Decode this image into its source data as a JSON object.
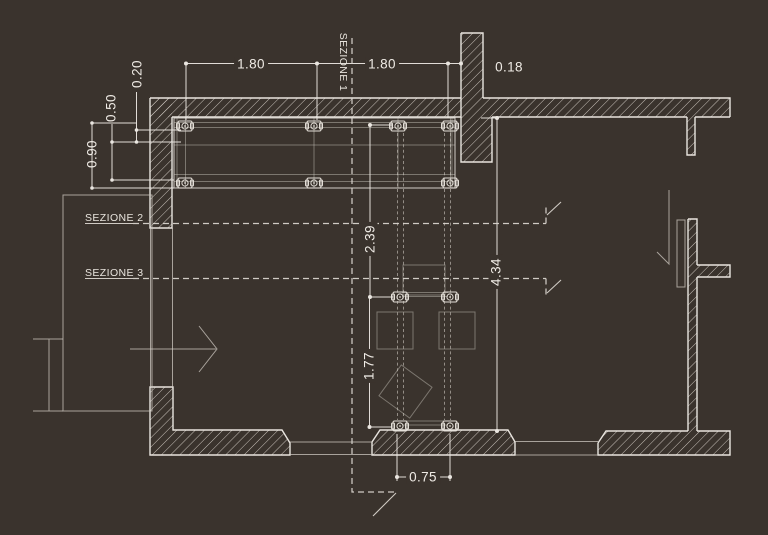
{
  "drawing": {
    "type": "architectural floor plan",
    "colors": {
      "background": "#3a332d",
      "line": "#e9e5df",
      "text": "#efebe5"
    },
    "dimensions": {
      "top_span_left": "1.80",
      "top_span_right": "1.80",
      "wall_thickness": "0.18",
      "offset_a": "0.20",
      "offset_b": "0.50",
      "offset_c": "0.90",
      "upper_room_depth": "2.39",
      "lower_room_depth": "1.77",
      "room_depth_total": "4.34",
      "passage_width": "0.75"
    },
    "sections": {
      "one": "SEZIONE 1",
      "two": "SEZIONE 2",
      "three": "SEZIONE 3"
    }
  }
}
